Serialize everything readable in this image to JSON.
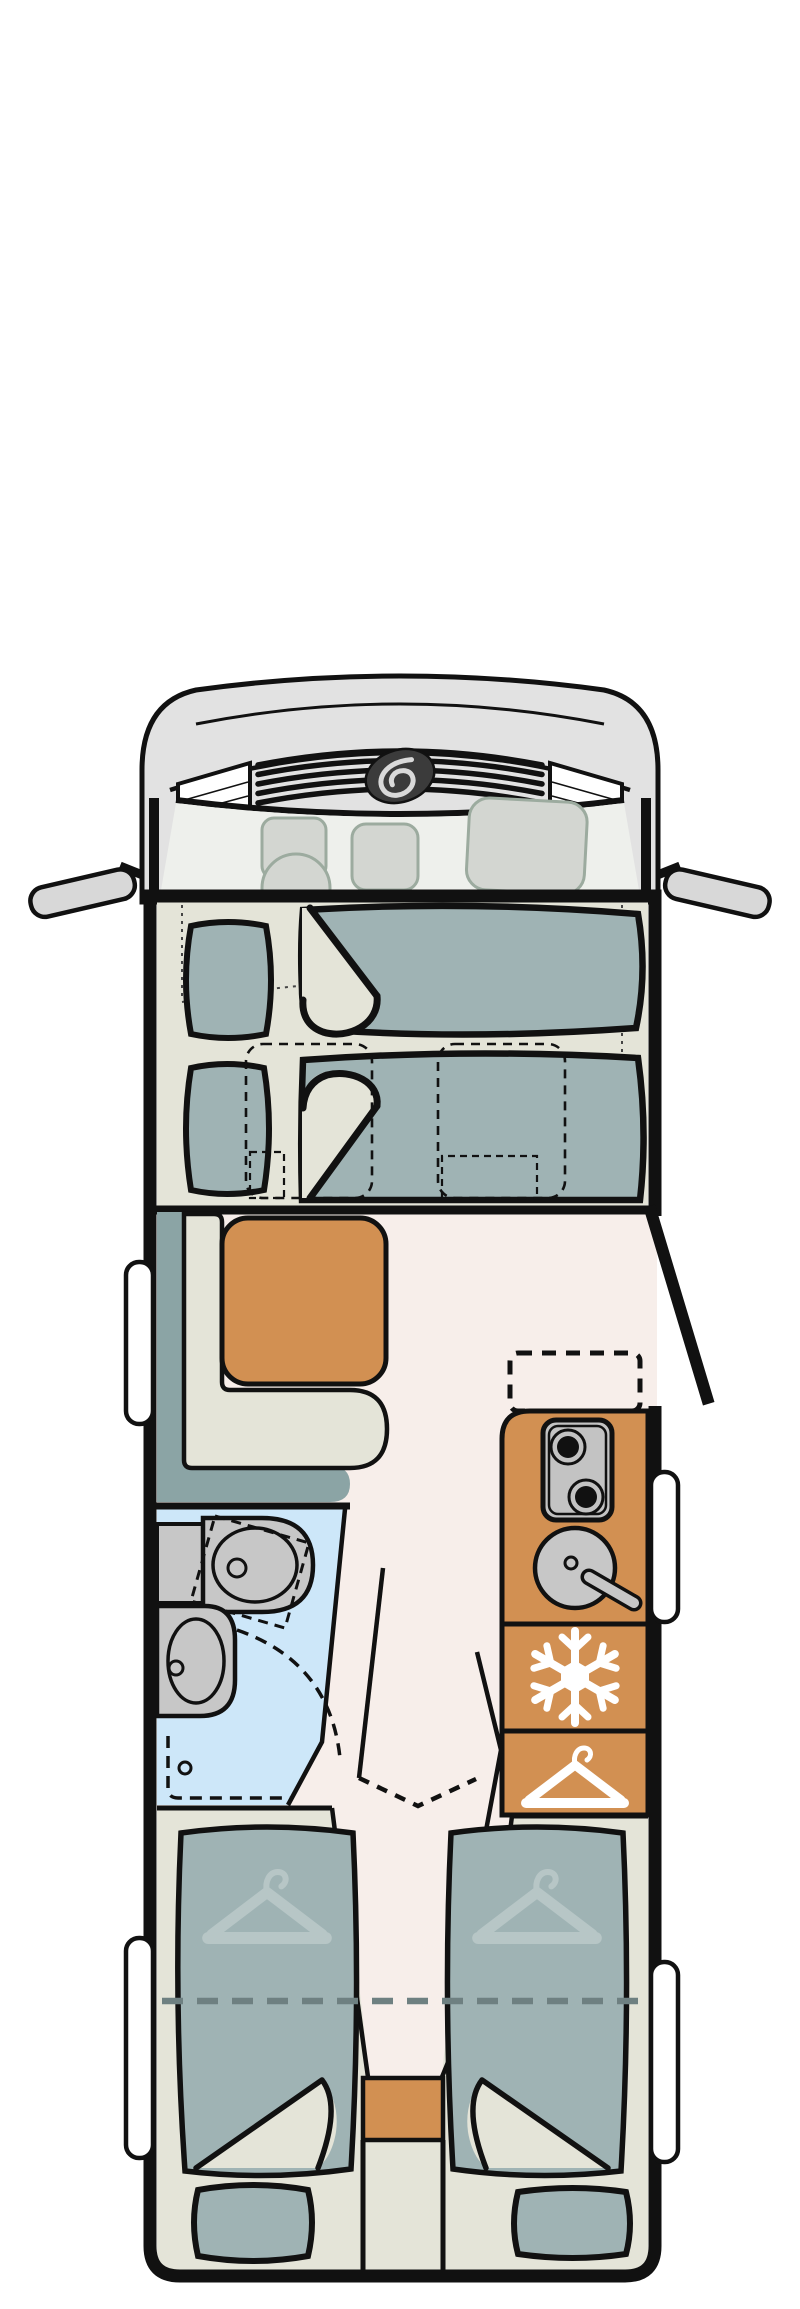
{
  "document": {
    "kind": "motorhome-floorplan-illustration",
    "view": "top-down",
    "text_content": "none"
  },
  "colors": {
    "outline": "#111111",
    "cab_body": "#e2e2e2",
    "cab_glass": "#eef0ec",
    "ghost_fill": "#d3d6d1",
    "ghost_stroke": "#9cab9f",
    "mirror": "#d8d8d8",
    "deck": "#e4e4d8",
    "textile": "#9fb3b4",
    "textile_pale": "#b7c6c6",
    "backrest": "#8ba4a5",
    "furniture_orange": "#d29052",
    "floor": "#f7eeea",
    "bath_blue": "#cde7f9",
    "fixture_gray": "#c7c7c7",
    "stove_gray": "#c3c3c3",
    "window_white": "#ffffff",
    "logo_dark": "#3b3b3b",
    "logo_swirl": "#d9d9d9",
    "fold_dash_gray": "#6e8081",
    "dotted_line": "#444444"
  },
  "icons": {
    "fridge": "snowflake-icon",
    "wardrobe": "hanger-icon",
    "bed_head_storage": "hanger-icon",
    "hob": "two-burner-icon",
    "sink": "round-bowl-with-faucet",
    "brand": "oval-swirl-logo"
  },
  "areas": {
    "front": "cab-with-mirrors",
    "over_cab": "drop-down-double-bed",
    "middle_left": "l-shaped-dinette-with-table",
    "middle_right": "entrance-door-and-kitchen",
    "aft_left": "bathroom",
    "aft_right": "fridge-and-wardrobe",
    "rear": "two-single-beds-with-rear-pillows"
  }
}
